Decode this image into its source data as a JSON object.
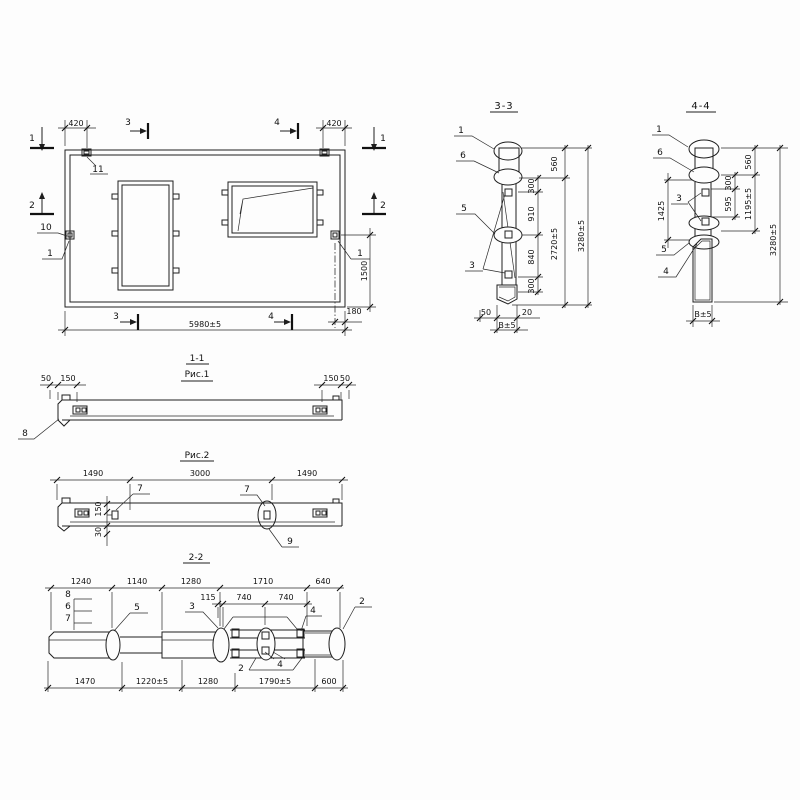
{
  "plan": {
    "dims": {
      "d420l": "420",
      "d420r": "420",
      "d5980": "5980±5",
      "d1500": "1500",
      "d180": "180"
    },
    "labels": {
      "l11": "11",
      "l10": "10",
      "l1l": "1",
      "l1r": "1"
    },
    "marks": {
      "m1l": "1",
      "m1r": "1",
      "m2l": "2",
      "m2r": "2",
      "m3t": "3",
      "m3b": "3",
      "m4t": "4",
      "m4b": "4"
    }
  },
  "s33": {
    "title": "3-3",
    "labels": {
      "p1": "1",
      "p6": "6",
      "p5": "5",
      "p3": "3"
    },
    "dims": {
      "d560": "560",
      "d300a": "300",
      "d910": "910",
      "d840": "840",
      "d300b": "300",
      "d2720": "2720±5",
      "d3280": "3280±5",
      "d50": "50",
      "d20": "20",
      "db": "В±5"
    }
  },
  "s44": {
    "title": "4-4",
    "labels": {
      "p1": "1",
      "p6": "6",
      "p3": "3",
      "p5": "5",
      "p4": "4"
    },
    "dims": {
      "d1425": "1425",
      "d300": "300",
      "d560": "560",
      "d595": "595",
      "d1195": "1195±5",
      "d3280": "3280±5",
      "db": "В±5"
    }
  },
  "fig1": {
    "title": "1-1",
    "caption": "Рис.1",
    "dims": {
      "d50l": "50",
      "d150l": "150",
      "d150r": "150",
      "d50r": "50"
    },
    "labels": {
      "p8": "8"
    }
  },
  "fig2": {
    "title": "Рис.2",
    "dims": {
      "d1490l": "1490",
      "d3000": "3000",
      "d1490r": "1490",
      "d150": "150",
      "d30": "30"
    },
    "labels": {
      "p7a": "7",
      "p7b": "7",
      "p9": "9"
    }
  },
  "s22": {
    "title": "2-2",
    "dims_top": [
      "1240",
      "1140",
      "1280",
      "1710",
      "640"
    ],
    "dims_sub": [
      "115",
      "740",
      "740"
    ],
    "dims_bottom": [
      "1470",
      "1220±5",
      "1280",
      "1790±5",
      "600"
    ],
    "labels": {
      "p8": "8",
      "p6": "6",
      "p7": "7",
      "p5": "5",
      "p3": "3",
      "p4a": "4",
      "p4b": "4",
      "p2a": "2",
      "p2b": "2"
    }
  }
}
